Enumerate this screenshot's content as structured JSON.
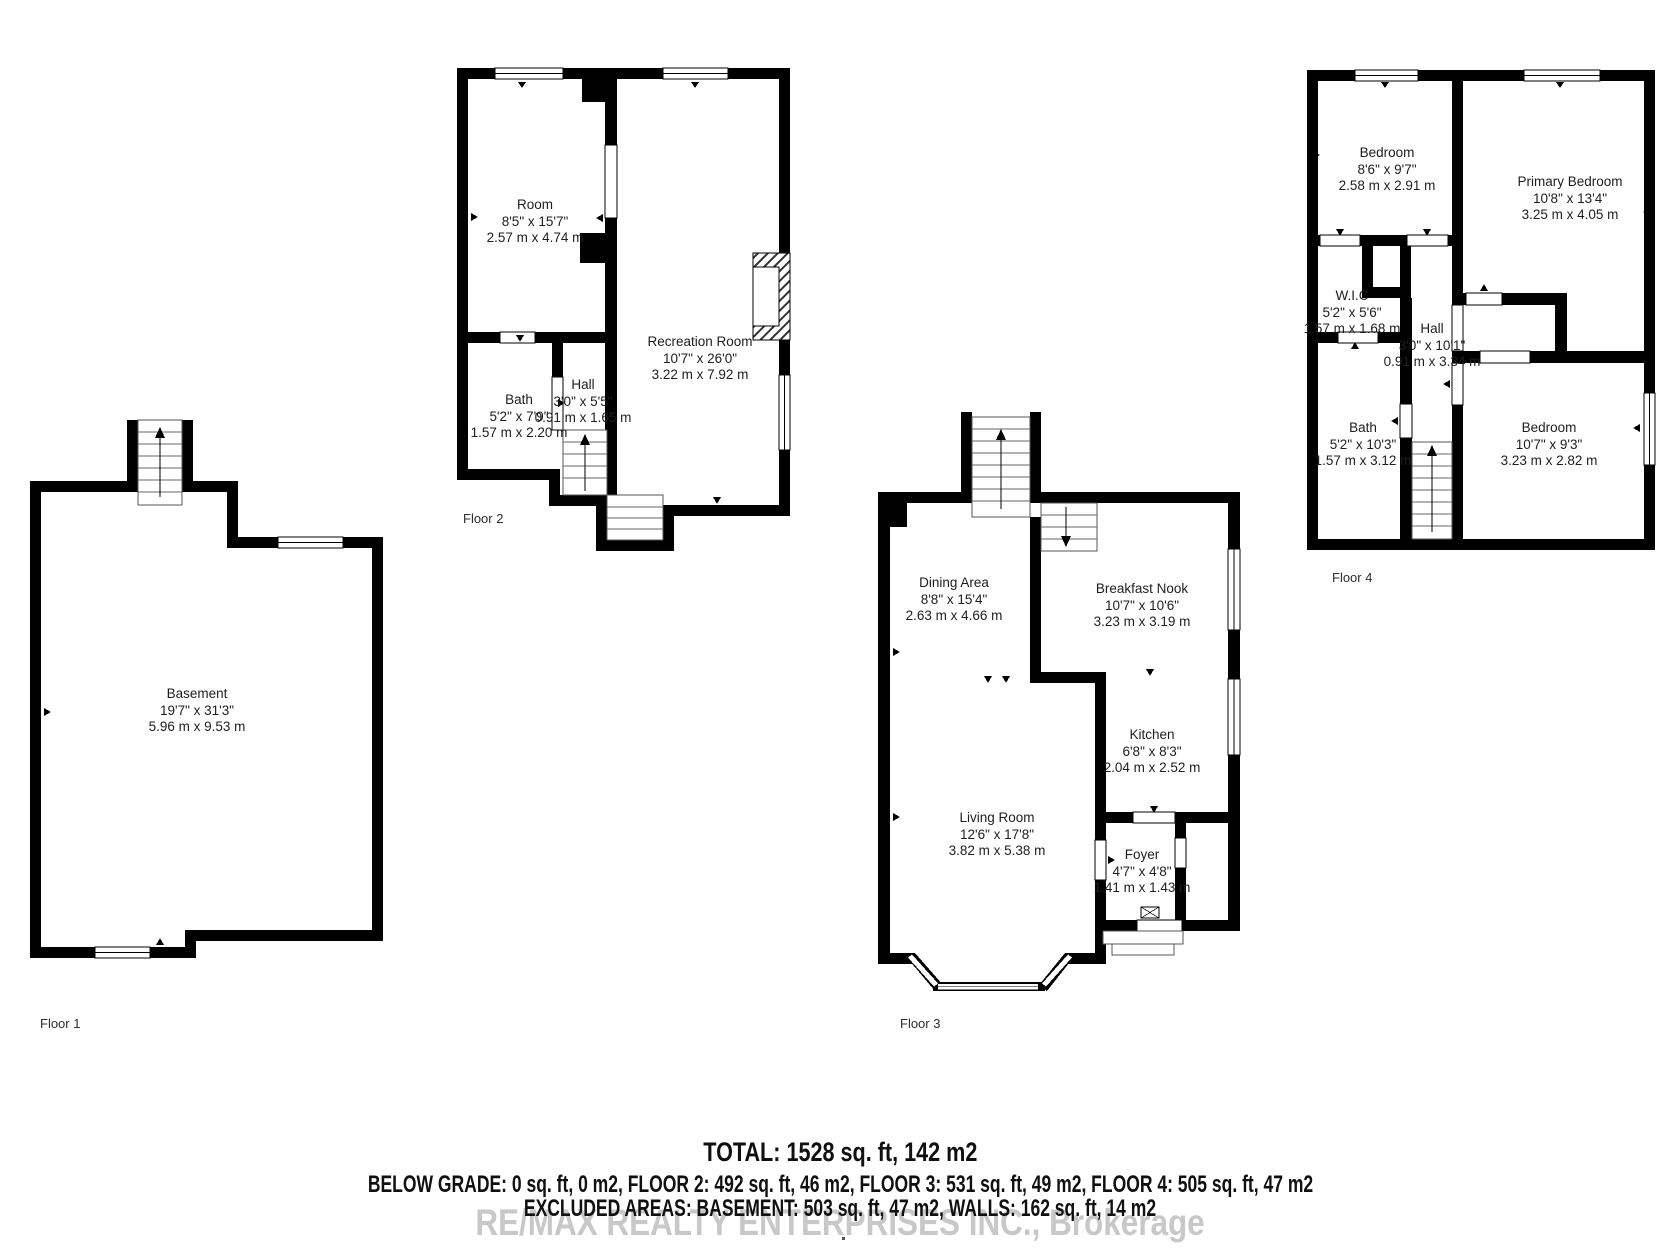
{
  "floors": [
    {
      "label": "Floor 1",
      "rooms": [
        {
          "name": "Basement",
          "imperial": "19'7\" x 31'3\"",
          "metric": "5.96 m x 9.53 m"
        }
      ]
    },
    {
      "label": "Floor 2",
      "rooms": [
        {
          "name": "Room",
          "imperial": "8'5\" x 15'7\"",
          "metric": "2.57 m x 4.74 m"
        },
        {
          "name": "Bath",
          "imperial": "5'2\" x 7'9\"",
          "metric": "1.57 m x 2.20 m"
        },
        {
          "name": "Hall",
          "imperial": "3'0\" x 5'5\"",
          "metric": "0.91 m x 1.65 m"
        },
        {
          "name": "Recreation Room",
          "imperial": "10'7\" x 26'0\"",
          "metric": "3.22 m x 7.92 m"
        }
      ]
    },
    {
      "label": "Floor 3",
      "rooms": [
        {
          "name": "Dining Area",
          "imperial": "8'8\" x 15'4\"",
          "metric": "2.63 m x 4.66 m"
        },
        {
          "name": "Breakfast Nook",
          "imperial": "10'7\" x 10'6\"",
          "metric": "3.23 m x 3.19 m"
        },
        {
          "name": "Kitchen",
          "imperial": "6'8\" x 8'3\"",
          "metric": "2.04 m x 2.52 m"
        },
        {
          "name": "Living Room",
          "imperial": "12'6\" x 17'8\"",
          "metric": "3.82 m x 5.38 m"
        },
        {
          "name": "Foyer",
          "imperial": "4'7\" x 4'8\"",
          "metric": "1.41 m x 1.43 m"
        }
      ]
    },
    {
      "label": "Floor 4",
      "rooms": [
        {
          "name": "Bedroom",
          "imperial": "8'6\" x 9'7\"",
          "metric": "2.58 m x 2.91 m"
        },
        {
          "name": "Primary Bedroom",
          "imperial": "10'8\" x 13'4\"",
          "metric": "3.25 m x 4.05 m"
        },
        {
          "name": "W.I.C",
          "imperial": "5'2\" x 5'6\"",
          "metric": "1.57 m x 1.68 m"
        },
        {
          "name": "Hall",
          "imperial": "3'0\" x 10'1\"",
          "metric": "0.91 m x 3.34 m"
        },
        {
          "name": "Bath",
          "imperial": "5'2\" x 10'3\"",
          "metric": "1.57 m x 3.12 m"
        },
        {
          "name": "Bedroom",
          "imperial": "10'7\" x 9'3\"",
          "metric": "3.23 m x 2.82 m"
        }
      ]
    }
  ],
  "summary": {
    "total": "TOTAL: 1528 sq. ft, 142 m2",
    "floors_line": "BELOW GRADE: 0 sq. ft, 0 m2, FLOOR 2: 492 sq. ft, 46 m2, FLOOR 3: 531 sq. ft, 49 m2, FLOOR 4: 505 sq. ft, 47 m2",
    "excluded_line": "EXCLUDED AREAS: BASEMENT: 503 sq. ft, 47 m2, WALLS: 162 sq. ft, 14 m2",
    "watermark": "RE/MAX REALTY ENTERPRISES INC., Brokerage"
  },
  "colors": {
    "walls": "#000000",
    "background": "#ffffff",
    "watermark_text": "#c8c8c8"
  }
}
